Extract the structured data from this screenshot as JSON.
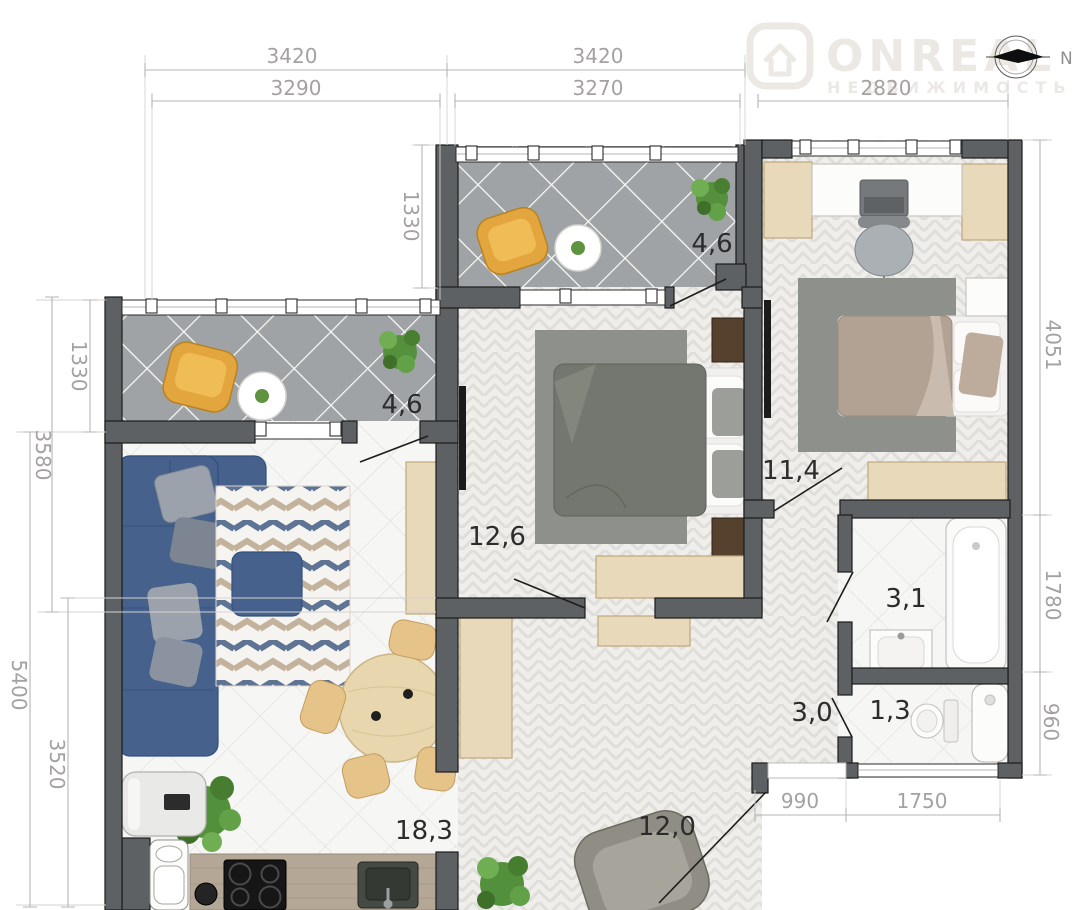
{
  "logo": {
    "brand": "ONREAL",
    "tagline": "НЕДВИЖИМОСТЬ"
  },
  "compass": {
    "label": "N"
  },
  "dimensions": {
    "top_left_outer": "3420",
    "top_left_inner": "3290",
    "top_mid_outer": "3420",
    "top_mid_inner": "3270",
    "top_right": "2820",
    "balcony_top_height": "1330",
    "balcony_left_height": "1330",
    "left_upper": "3580",
    "left_outer": "5400",
    "left_lower_inner": "3520",
    "right_upper": "4051",
    "right_middle": "1780",
    "right_lower": "960",
    "bottom_entry": "990",
    "bottom_window": "1750"
  },
  "rooms": {
    "balcony_top": {
      "label": "balcony",
      "area": "4,6"
    },
    "balcony_left": {
      "label": "balcony",
      "area": "4,6"
    },
    "bedroom_main": {
      "label": "bedroom",
      "area": "12,6"
    },
    "bedroom_second": {
      "label": "bedroom",
      "area": "11,4"
    },
    "bathroom": {
      "label": "bathroom",
      "area": "3,1"
    },
    "corridor": {
      "label": "corridor",
      "area": "3,0"
    },
    "wc": {
      "label": "wc",
      "area": "1,3"
    },
    "kitchen_living": {
      "label": "kitchen-living room",
      "area": "18,3"
    },
    "hallway": {
      "label": "hallway",
      "area": "12,0"
    }
  },
  "colors": {
    "wall": "#5e6164",
    "sofa": "#46618c",
    "chair": "#e3a53d",
    "wood": "#e8d9ba",
    "dim_text": "#a3a2a0",
    "area_text": "#2c2c2c",
    "logo": "#ece9e5",
    "balcony_floor": "#a0a3a5",
    "rug_blue": "#5d7495",
    "rug_tan": "#c3b29c"
  }
}
